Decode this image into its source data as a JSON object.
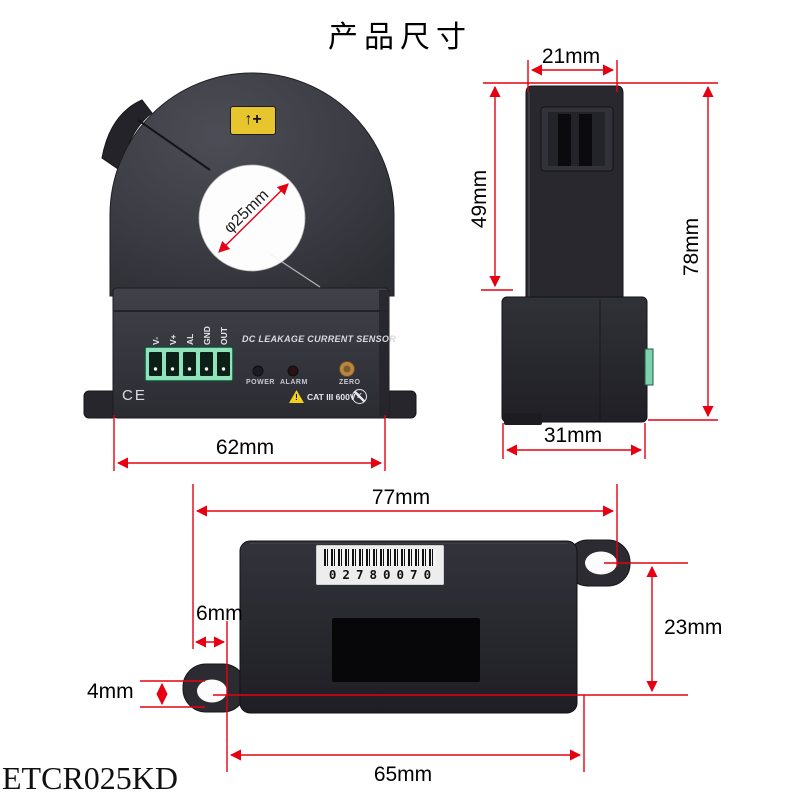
{
  "title": "产品尺寸",
  "model": "ETCR025KD",
  "colors": {
    "dimension_line": "#e60012",
    "device_body": "#35353c",
    "polarity_label_bg": "#e7c52f",
    "terminal_block_green": "#8ee3bd",
    "zero_button": "#b9873f",
    "barcode_label_bg": "#ededed"
  },
  "front_view": {
    "polarity_mark": "↑+",
    "aperture": "φ25mm",
    "overall_width": "62mm",
    "terminals": [
      "V-",
      "V+",
      "AL",
      "GND",
      "OUT"
    ],
    "panel_title": "DC LEAKAGE CURRENT SENSOR",
    "power_label": "POWER",
    "alarm_label": "ALARM",
    "zero_label": "ZERO",
    "ce_mark": "CE",
    "warning_mark": "!",
    "rating": "CAT III 600V",
    "crossed_mark": "K"
  },
  "side_view": {
    "top_width": "21mm",
    "clamp_height": "49mm",
    "overall_height": "78mm",
    "base_width": "31mm"
  },
  "bottom_view": {
    "overall_width": "77mm",
    "hole_edge_offset": "6mm",
    "hole_height": "4mm",
    "hole_vertical_pitch": "23mm",
    "hole_horizontal_pitch": "65mm",
    "barcode_number": "02780070"
  }
}
